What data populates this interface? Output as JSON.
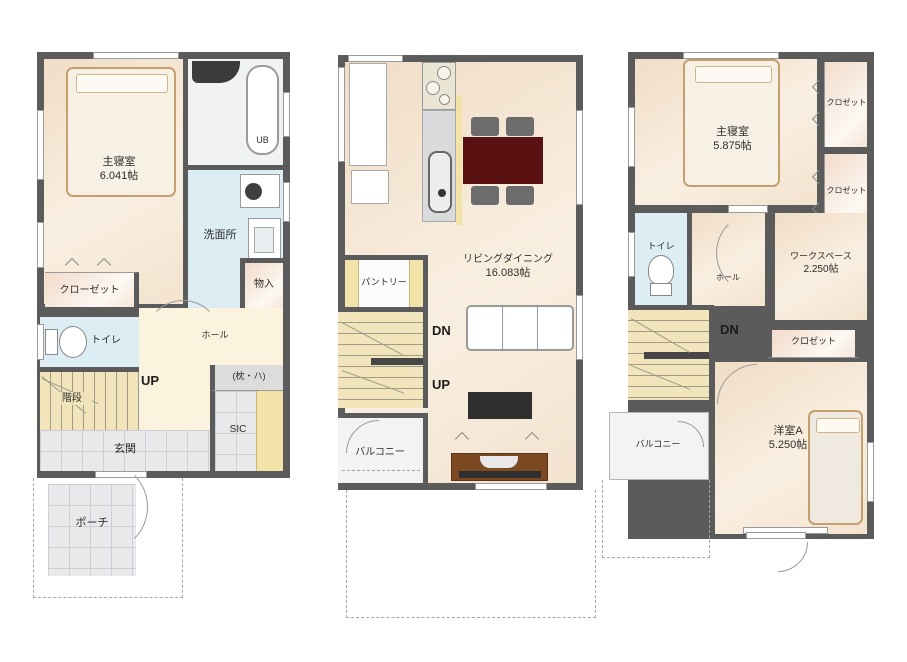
{
  "plan_title": "3-story residence floor plan",
  "colors": {
    "wall": "#5c5b5b",
    "room_floor": "#f5e7d4",
    "hall_floor": "#fbf3dd",
    "stairs_floor": "#f2e5bc",
    "wet_area_floor": "#dcedf3",
    "tile_floor": "#e9e9eb",
    "closet_floor": "#f4ddcd",
    "shelf_yellow": "#f3e3a9",
    "balcony_floor": "#f3f3f3",
    "dining_table": "#591111",
    "chair": "#6d6d6d",
    "tv_board": "#7b4a22",
    "tv": "#2f2f2f",
    "bed_outline": "#c3a06e"
  },
  "floor1": {
    "master_bedroom": {
      "label": "主寝室",
      "area": "6.041帖"
    },
    "unit_bath": {
      "label": "UB"
    },
    "washroom": {
      "label": "洗面所"
    },
    "storage": {
      "label": "物入"
    },
    "closet": {
      "label": "クローゼット"
    },
    "toilet": {
      "label": "トイレ"
    },
    "hall": {
      "label": "ホール"
    },
    "stairs": {
      "label": "階段",
      "direction": "UP"
    },
    "shelf": {
      "label": "(枕・ハ)"
    },
    "shoe_closet": {
      "label": "SIC"
    },
    "entrance": {
      "label": "玄関"
    },
    "porch": {
      "label": "ポーチ"
    }
  },
  "floor2": {
    "living_dining": {
      "label": "リビングダイニング",
      "area": "16.083帖"
    },
    "pantry": {
      "label": "パントリー"
    },
    "stairs": {
      "down": "DN",
      "up": "UP"
    },
    "balcony": {
      "label": "バルコニー"
    }
  },
  "floor3": {
    "master_bedroom": {
      "label": "主寝室",
      "area": "5.875帖"
    },
    "closet_top": {
      "label": "クロゼット"
    },
    "closet_mid": {
      "label": "クロゼット"
    },
    "closet_lower": {
      "label": "クロゼット"
    },
    "toilet": {
      "label": "トイレ"
    },
    "hall": {
      "label": "ホール"
    },
    "workspace": {
      "label": "ワークスペース",
      "area": "2.250帖"
    },
    "stairs": {
      "down": "DN"
    },
    "balcony": {
      "label": "バルコニー"
    },
    "room_a": {
      "label": "洋室A",
      "area": "5.250帖"
    }
  }
}
